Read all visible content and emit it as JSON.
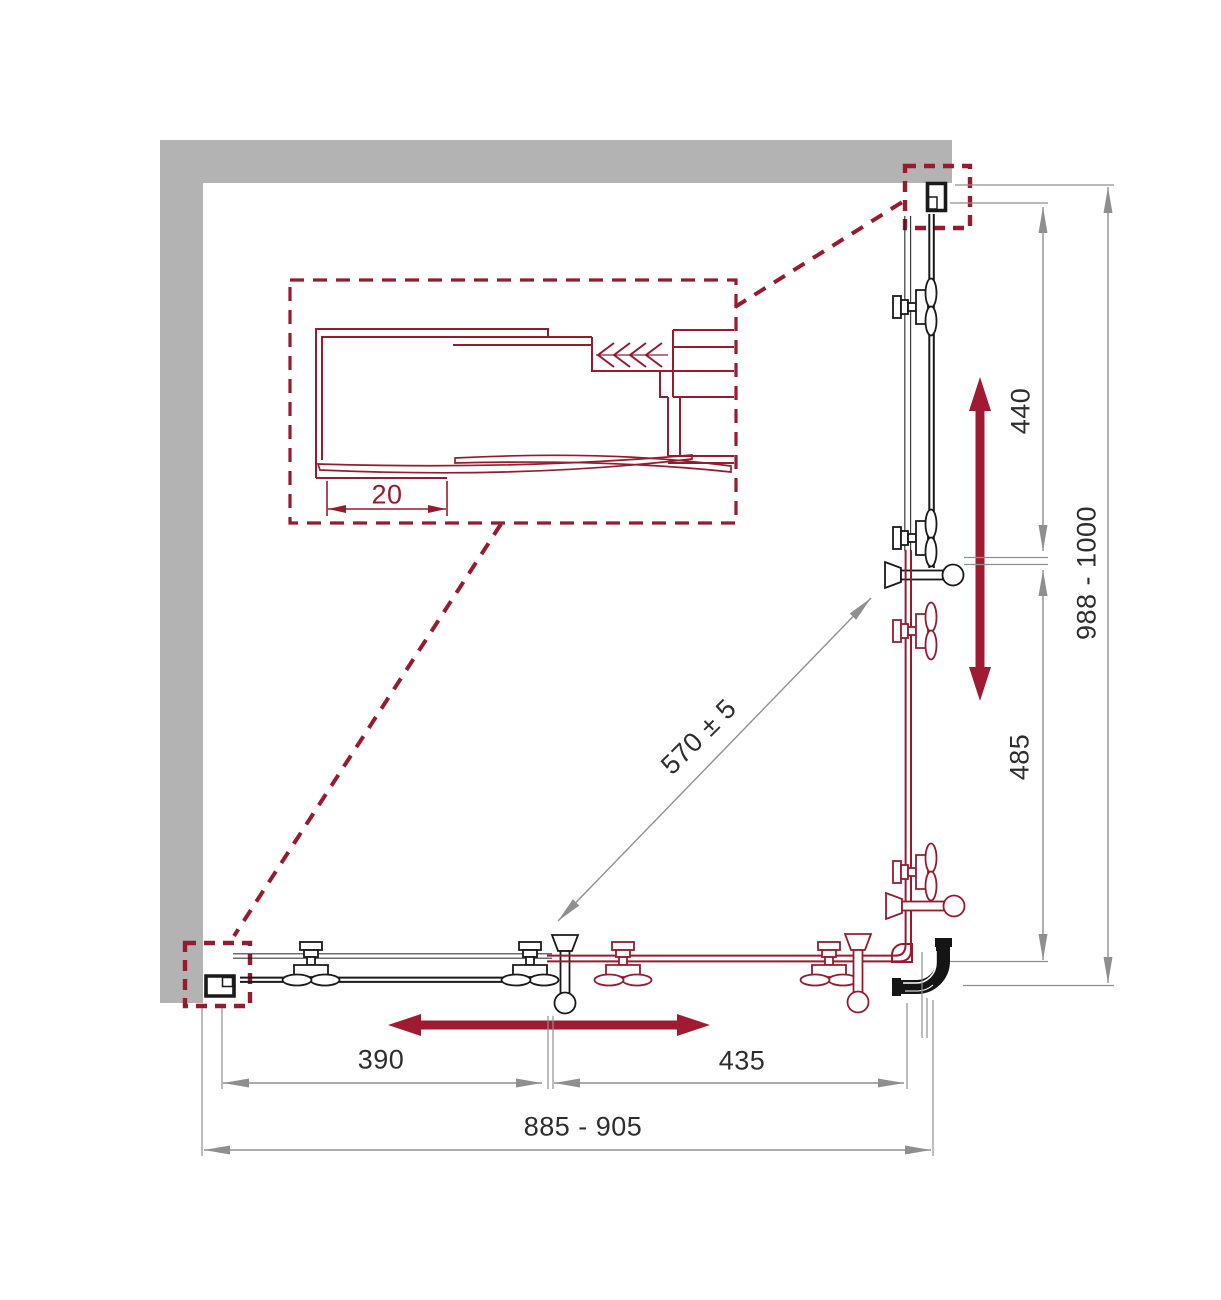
{
  "drawing": {
    "labels": {
      "detail_offset": "20",
      "bottom_left": "390",
      "bottom_right": "435",
      "bottom_overall": "885 - 905",
      "right_upper": "440",
      "right_lower": "485",
      "right_overall": "988 - 1000",
      "diagonal": "570 ± 5"
    },
    "colors": {
      "wall": "#b3b3b3",
      "out": "#1a1a1a",
      "dim": "#8f8f8f",
      "acc": "#971b2e",
      "arrow": "#a01a32",
      "text": "#2e2e2e",
      "bg": "#ffffff"
    }
  }
}
